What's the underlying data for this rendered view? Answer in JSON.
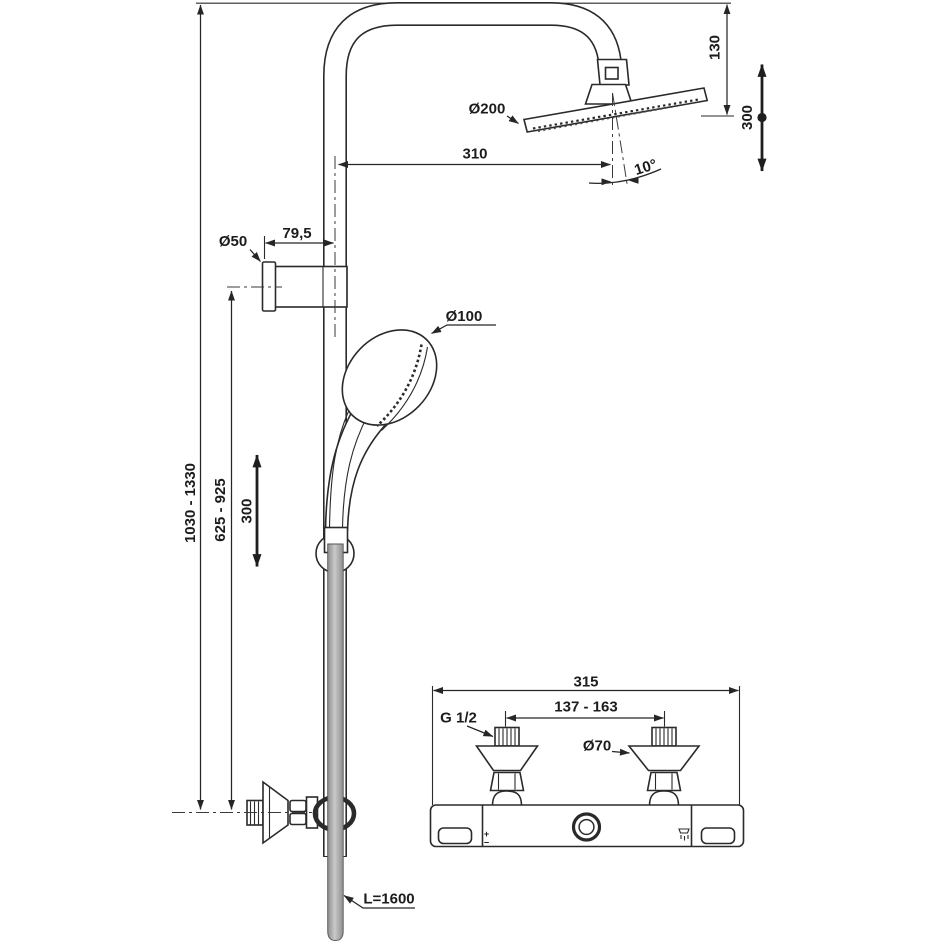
{
  "colors": {
    "line": "#2a2a2a",
    "text": "#1c1c1c",
    "hose": "#ababab",
    "background": "#ffffff"
  },
  "labels": {
    "overall_height_range": "1030 - 1330",
    "handset_height_range": "625 - 925",
    "handset_adjustment": "300",
    "rosette_diameter": "Ø50",
    "bracket_projection": "79,5",
    "handspray_diameter": "Ø100",
    "rainhead_diameter": "Ø200",
    "rainhead_projection": "310",
    "rainhead_drop": "130",
    "rainhead_adjustment": "300",
    "rainhead_angle": "10°",
    "hose_length": "L=1600",
    "mixer_width": "315",
    "inlet_centres": "137 - 163",
    "inlet_thread": "G 1/2",
    "inlet_rosette_diameter": "Ø70",
    "mixer_plus": "+",
    "mixer_minus": "−"
  }
}
